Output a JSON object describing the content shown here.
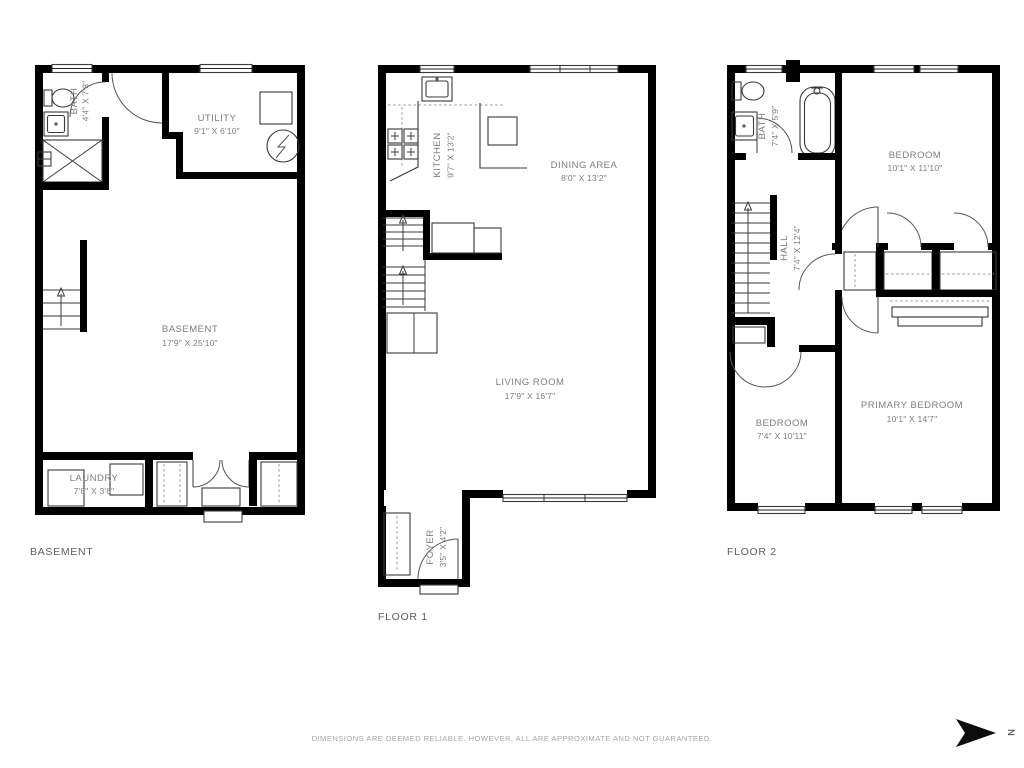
{
  "page": {
    "disclaimer": "DIMENSIONS ARE DEEMED RELIABLE. HOWEVER, ALL ARE APPROXIMATE AND NOT GUARANTEED.",
    "compass": {
      "letter": "N",
      "direction": "right"
    },
    "icons": [
      "toilet",
      "sink",
      "bathtub",
      "stove",
      "washer",
      "dryer",
      "water-heater",
      "furnace",
      "stairs",
      "door-arc",
      "window",
      "closet",
      "north-arrow"
    ]
  },
  "colors": {
    "wall": "#000000",
    "thin_line": "#3a3a3a",
    "room_label": "#7d7d7d",
    "floor_label": "#606060",
    "disclaimer": "#a5a5a5"
  },
  "floors": [
    {
      "id": "basement",
      "label": "BASEMENT",
      "rooms": [
        {
          "name": "BATH",
          "dims": "4'4\" X 7'3\""
        },
        {
          "name": "UTILITY",
          "dims": "9'1\" X 6'10\""
        },
        {
          "name": "BASEMENT",
          "dims": "17'9\" X 25'10\""
        },
        {
          "name": "LAUNDRY",
          "dims": "7'8\" X 3'6\""
        }
      ]
    },
    {
      "id": "floor-1",
      "label": "FLOOR 1",
      "rooms": [
        {
          "name": "KITCHEN",
          "dims": "9'7\" X 13'2\""
        },
        {
          "name": "DINING AREA",
          "dims": "8'0\" X 13'2\""
        },
        {
          "name": "LIVING ROOM",
          "dims": "17'9\" X 16'7\""
        },
        {
          "name": "FOYER",
          "dims": "3'5\" X 4'2\""
        }
      ]
    },
    {
      "id": "floor-2",
      "label": "FLOOR 2",
      "rooms": [
        {
          "name": "BATH",
          "dims": "7'4\" X 5'9\""
        },
        {
          "name": "BEDROOM",
          "dims": "10'1\" X 11'10\""
        },
        {
          "name": "HALL",
          "dims": "7'4\" X 12'4\""
        },
        {
          "name": "BEDROOM",
          "dims": "7'4\" X 10'11\""
        },
        {
          "name": "PRIMARY BEDROOM",
          "dims": "10'1\" X 14'7\""
        }
      ]
    }
  ]
}
